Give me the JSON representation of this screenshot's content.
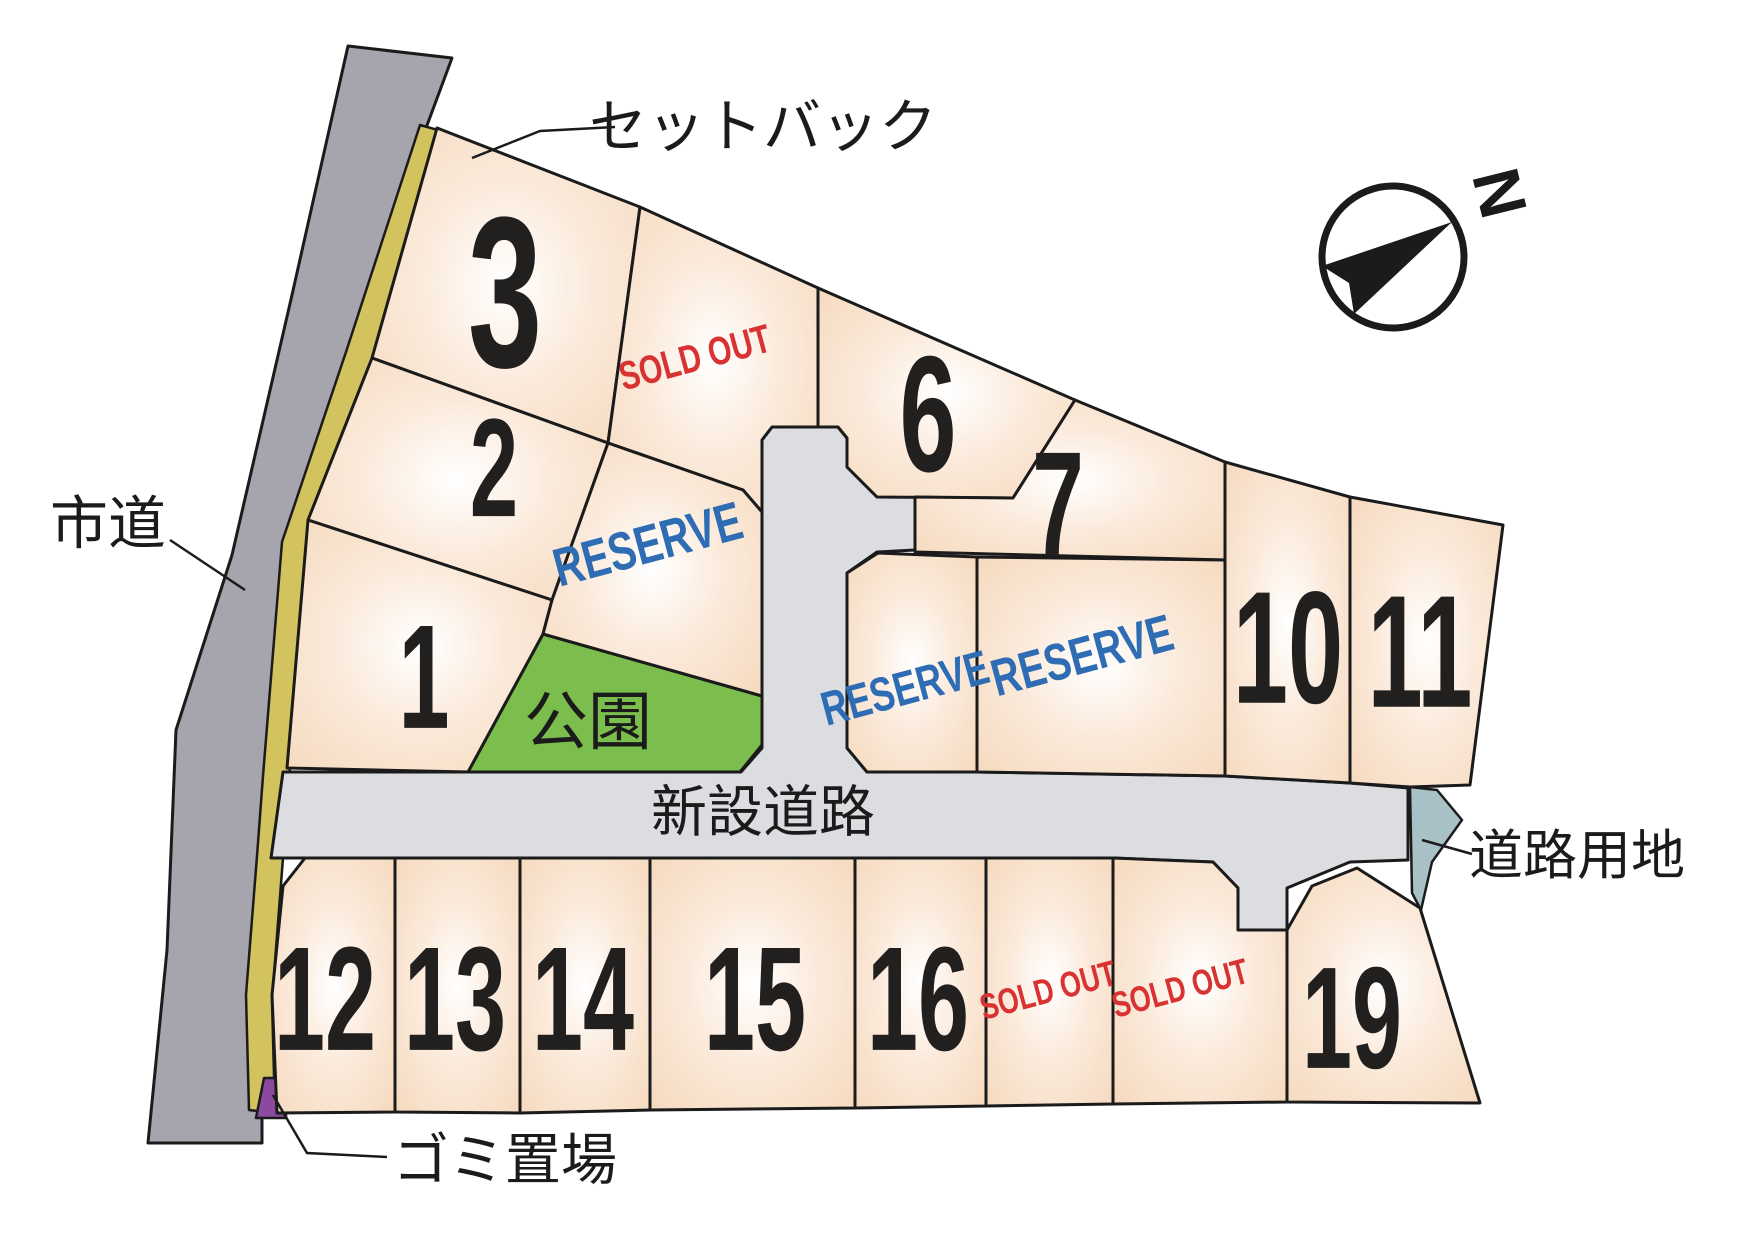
{
  "map": {
    "background": "#ffffff",
    "colors": {
      "outline": "#1b1b1b",
      "lot_edge": "#f5d9bd",
      "lot_mid": "#fbeadb",
      "lot_center": "#ffffff",
      "road_gray": "#dcdde1",
      "city_road": "#a6a4ac",
      "setback_yellow": "#d3c35f",
      "park_green": "#7cbe4e",
      "road_land": "#a8c1c7",
      "garbage_purple": "#8b4a9e",
      "sold_out_red": "#d93232",
      "reserve_blue": "#2e6cb4",
      "number_black": "#221f1f",
      "label_black": "#1b1b1b"
    },
    "labels": {
      "setback": "セットバック",
      "city_road": "市道",
      "new_road": "新設道路",
      "park": "公園",
      "road_land": "道路用地",
      "garbage": "ゴミ置場",
      "north": "N",
      "sold_out": "SOLD OUT",
      "reserve": "RESERVE"
    },
    "regions": [
      {
        "name": "city-road",
        "kind": "city_road",
        "stroke_w": 3,
        "points": [
          [
            348,
            46
          ],
          [
            452,
            58
          ],
          [
            426,
            128
          ],
          [
            350,
            352
          ],
          [
            286,
            542
          ],
          [
            267,
            776
          ],
          [
            261,
            856
          ],
          [
            250,
            995
          ],
          [
            262,
            1113
          ],
          [
            262,
            1143
          ],
          [
            148,
            1143
          ],
          [
            167,
            950
          ],
          [
            176,
            730
          ],
          [
            232,
            555
          ],
          [
            292,
            295
          ]
        ]
      },
      {
        "name": "setback-strip",
        "kind": "setback",
        "stroke_w": 2.5,
        "points": [
          [
            445,
            132
          ],
          [
            372,
            358
          ],
          [
            308,
            548
          ],
          [
            289,
            780
          ],
          [
            283,
            858
          ],
          [
            272,
            1000
          ],
          [
            275,
            1113
          ],
          [
            249,
            1110
          ],
          [
            246,
            995
          ],
          [
            257,
            856
          ],
          [
            263,
            776
          ],
          [
            282,
            542
          ],
          [
            346,
            352
          ],
          [
            420,
            125
          ]
        ]
      },
      {
        "name": "public-road",
        "kind": "road",
        "stroke_w": 3,
        "points": [
          [
            772,
            427
          ],
          [
            762,
            440
          ],
          [
            762,
            748
          ],
          [
            741,
            772
          ],
          [
            283,
            772
          ],
          [
            271,
            858
          ],
          [
            305,
            858
          ],
          [
            395,
            858
          ],
          [
            520,
            858
          ],
          [
            650,
            858
          ],
          [
            855,
            858
          ],
          [
            986,
            858
          ],
          [
            1113,
            858
          ],
          [
            1213,
            862
          ],
          [
            1238,
            888
          ],
          [
            1238,
            930
          ],
          [
            1287,
            930
          ],
          [
            1287,
            888
          ],
          [
            1350,
            862
          ],
          [
            1408,
            860
          ],
          [
            1408,
            788
          ],
          [
            1350,
            783
          ],
          [
            1225,
            776
          ],
          [
            977,
            772
          ],
          [
            867,
            772
          ],
          [
            847,
            748
          ],
          [
            847,
            573
          ],
          [
            877,
            552
          ],
          [
            915,
            550
          ],
          [
            915,
            497
          ],
          [
            877,
            497
          ],
          [
            847,
            467
          ],
          [
            847,
            438
          ],
          [
            838,
            427
          ]
        ]
      },
      {
        "name": "park",
        "kind": "park",
        "stroke_w": 3,
        "label_key": "park",
        "label_pos": [
          588,
          722
        ],
        "label_size": 64,
        "points": [
          [
            543,
            634
          ],
          [
            762,
            696
          ],
          [
            762,
            745
          ],
          [
            740,
            772
          ],
          [
            468,
            772
          ]
        ]
      },
      {
        "name": "road-land",
        "kind": "road_land",
        "stroke_w": 2.5,
        "points": [
          [
            1410,
            787
          ],
          [
            1437,
            790
          ],
          [
            1462,
            820
          ],
          [
            1432,
            862
          ],
          [
            1421,
            910
          ],
          [
            1412,
            893
          ]
        ]
      },
      {
        "name": "garbage-spot",
        "kind": "garbage",
        "stroke_w": 2.5,
        "points": [
          [
            264,
            1078
          ],
          [
            286,
            1078
          ],
          [
            286,
            1118
          ],
          [
            256,
            1118
          ]
        ]
      }
    ],
    "lots": [
      {
        "id": "lot-3",
        "number": "3",
        "status": "numbered",
        "label_pos": [
          505,
          292
        ],
        "label_size": 215,
        "label_rot": 0,
        "points": [
          [
            437,
            128
          ],
          [
            640,
            207
          ],
          [
            608,
            443
          ],
          [
            372,
            358
          ]
        ]
      },
      {
        "id": "lot-2",
        "number": "2",
        "status": "numbered",
        "label_pos": [
          494,
          468
        ],
        "label_size": 140,
        "label_rot": 0,
        "points": [
          [
            372,
            358
          ],
          [
            608,
            443
          ],
          [
            552,
            600
          ],
          [
            308,
            520
          ]
        ]
      },
      {
        "id": "lot-1",
        "number": "1",
        "status": "numbered",
        "label_pos": [
          424,
          678
        ],
        "label_size": 148,
        "label_rot": 0,
        "points": [
          [
            308,
            520
          ],
          [
            552,
            600
          ],
          [
            543,
            634
          ],
          [
            468,
            772
          ],
          [
            287,
            768
          ]
        ]
      },
      {
        "id": "lot-sold-top",
        "number": "",
        "status": "sold",
        "label_pos": [
          695,
          358
        ],
        "label_size": 40,
        "label_rot": -15,
        "points": [
          [
            640,
            207
          ],
          [
            818,
            288
          ],
          [
            818,
            427
          ],
          [
            772,
            427
          ],
          [
            762,
            440
          ],
          [
            762,
            512
          ],
          [
            743,
            490
          ],
          [
            608,
            443
          ]
        ]
      },
      {
        "id": "lot-6",
        "number": "6",
        "status": "numbered",
        "label_pos": [
          928,
          415
        ],
        "label_size": 165,
        "label_rot": 0,
        "points": [
          [
            818,
            288
          ],
          [
            1075,
            400
          ],
          [
            1013,
            498
          ],
          [
            877,
            497
          ],
          [
            847,
            467
          ],
          [
            847,
            438
          ],
          [
            838,
            427
          ],
          [
            818,
            427
          ]
        ]
      },
      {
        "id": "lot-7",
        "number": "7",
        "status": "numbered",
        "label_pos": [
          1058,
          505
        ],
        "label_size": 150,
        "label_rot": 0,
        "points": [
          [
            1075,
            400
          ],
          [
            1225,
            462
          ],
          [
            1225,
            560
          ],
          [
            915,
            552
          ],
          [
            915,
            497
          ],
          [
            1013,
            498
          ]
        ]
      },
      {
        "id": "lot-reserve-1",
        "number": "",
        "status": "reserved",
        "label_pos": [
          648,
          545
        ],
        "label_size": 54,
        "label_rot": -15,
        "points": [
          [
            608,
            443
          ],
          [
            743,
            490
          ],
          [
            762,
            512
          ],
          [
            762,
            696
          ],
          [
            543,
            634
          ],
          [
            552,
            600
          ]
        ]
      },
      {
        "id": "lot-reserve-2",
        "number": "",
        "status": "reserved",
        "label_pos": [
          905,
          688
        ],
        "label_size": 48,
        "label_rot": -15,
        "points": [
          [
            847,
            573
          ],
          [
            878,
            553
          ],
          [
            977,
            557
          ],
          [
            977,
            772
          ],
          [
            867,
            772
          ],
          [
            847,
            748
          ]
        ]
      },
      {
        "id": "lot-reserve-3",
        "number": "",
        "status": "reserved",
        "label_pos": [
          1082,
          655
        ],
        "label_size": 52,
        "label_rot": -15,
        "points": [
          [
            977,
            557
          ],
          [
            1225,
            560
          ],
          [
            1225,
            776
          ],
          [
            977,
            772
          ]
        ]
      },
      {
        "id": "lot-10",
        "number": "10",
        "status": "numbered",
        "label_pos": [
          1288,
          648
        ],
        "label_size": 160,
        "label_rot": 0,
        "points": [
          [
            1225,
            462
          ],
          [
            1350,
            497
          ],
          [
            1350,
            783
          ],
          [
            1225,
            776
          ]
        ]
      },
      {
        "id": "lot-11",
        "number": "11",
        "status": "numbered",
        "label_pos": [
          1420,
          652
        ],
        "label_size": 160,
        "label_rot": 0,
        "points": [
          [
            1350,
            497
          ],
          [
            1503,
            525
          ],
          [
            1470,
            785
          ],
          [
            1410,
            787
          ],
          [
            1350,
            783
          ]
        ]
      },
      {
        "id": "lot-12",
        "number": "12",
        "status": "numbered",
        "label_pos": [
          325,
          1000
        ],
        "label_size": 148,
        "label_rot": 0,
        "points": [
          [
            305,
            858
          ],
          [
            395,
            858
          ],
          [
            395,
            1112
          ],
          [
            277,
            1113
          ],
          [
            272,
            995
          ],
          [
            283,
            886
          ]
        ]
      },
      {
        "id": "lot-13",
        "number": "13",
        "status": "numbered",
        "label_pos": [
          455,
          1000
        ],
        "label_size": 148,
        "label_rot": 0,
        "points": [
          [
            395,
            858
          ],
          [
            520,
            858
          ],
          [
            520,
            1113
          ],
          [
            395,
            1112
          ]
        ]
      },
      {
        "id": "lot-14",
        "number": "14",
        "status": "numbered",
        "label_pos": [
          583,
          1000
        ],
        "label_size": 148,
        "label_rot": 0,
        "points": [
          [
            520,
            858
          ],
          [
            650,
            858
          ],
          [
            650,
            1110
          ],
          [
            520,
            1113
          ]
        ]
      },
      {
        "id": "lot-15",
        "number": "15",
        "status": "numbered",
        "label_pos": [
          755,
          1000
        ],
        "label_size": 148,
        "label_rot": 0,
        "points": [
          [
            650,
            858
          ],
          [
            855,
            858
          ],
          [
            855,
            1108
          ],
          [
            650,
            1110
          ]
        ]
      },
      {
        "id": "lot-16",
        "number": "16",
        "status": "numbered",
        "label_pos": [
          918,
          1000
        ],
        "label_size": 148,
        "label_rot": 0,
        "points": [
          [
            855,
            858
          ],
          [
            986,
            858
          ],
          [
            986,
            1106
          ],
          [
            855,
            1108
          ]
        ]
      },
      {
        "id": "lot-sold-b1",
        "number": "",
        "status": "sold",
        "label_pos": [
          1048,
          990
        ],
        "label_size": 36,
        "label_rot": -15,
        "points": [
          [
            986,
            858
          ],
          [
            1113,
            858
          ],
          [
            1113,
            1104
          ],
          [
            986,
            1106
          ]
        ]
      },
      {
        "id": "lot-sold-b2",
        "number": "",
        "status": "sold",
        "label_pos": [
          1180,
          988
        ],
        "label_size": 36,
        "label_rot": -15,
        "points": [
          [
            1113,
            858
          ],
          [
            1213,
            862
          ],
          [
            1238,
            888
          ],
          [
            1238,
            930
          ],
          [
            1287,
            930
          ],
          [
            1287,
            1102
          ],
          [
            1113,
            1104
          ]
        ]
      },
      {
        "id": "lot-19",
        "number": "19",
        "status": "numbered",
        "label_pos": [
          1352,
          1018
        ],
        "label_size": 145,
        "label_rot": 0,
        "points": [
          [
            1287,
            930
          ],
          [
            1312,
            886
          ],
          [
            1357,
            868
          ],
          [
            1420,
            908
          ],
          [
            1480,
            1103
          ],
          [
            1287,
            1102
          ]
        ]
      }
    ],
    "annotations": [
      {
        "id": "setback",
        "label_key": "setback",
        "pos": [
          763,
          127
        ],
        "size": 58,
        "leader": [
          [
            615,
            127
          ],
          [
            540,
            131
          ],
          [
            472,
            158
          ]
        ]
      },
      {
        "id": "city-road",
        "label_key": "city_road",
        "pos": [
          108,
          524
        ],
        "size": 58,
        "leader": [
          [
            170,
            540
          ],
          [
            245,
            590
          ]
        ]
      },
      {
        "id": "new-road",
        "label_key": "new_road",
        "pos": [
          763,
          812
        ],
        "size": 56,
        "leader": []
      },
      {
        "id": "road-land",
        "label_key": "road_land",
        "pos": [
          1577,
          856
        ],
        "size": 54,
        "leader": [
          [
            1422,
            840
          ],
          [
            1472,
            854
          ]
        ]
      },
      {
        "id": "garbage",
        "label_key": "garbage",
        "pos": [
          505,
          1160
        ],
        "size": 56,
        "leader": [
          [
            273,
            1095
          ],
          [
            307,
            1153
          ],
          [
            387,
            1157
          ]
        ]
      }
    ],
    "compass": {
      "cx": 1393,
      "cy": 257,
      "r": 71,
      "ring_w": 7,
      "arrow": [
        [
          1452,
          222
        ],
        [
          1322,
          266
        ],
        [
          1349,
          283
        ],
        [
          1354,
          314
        ]
      ],
      "label_key": "north",
      "label_pos": [
        1500,
        193
      ],
      "label_rot": 76,
      "label_size": 66
    }
  }
}
